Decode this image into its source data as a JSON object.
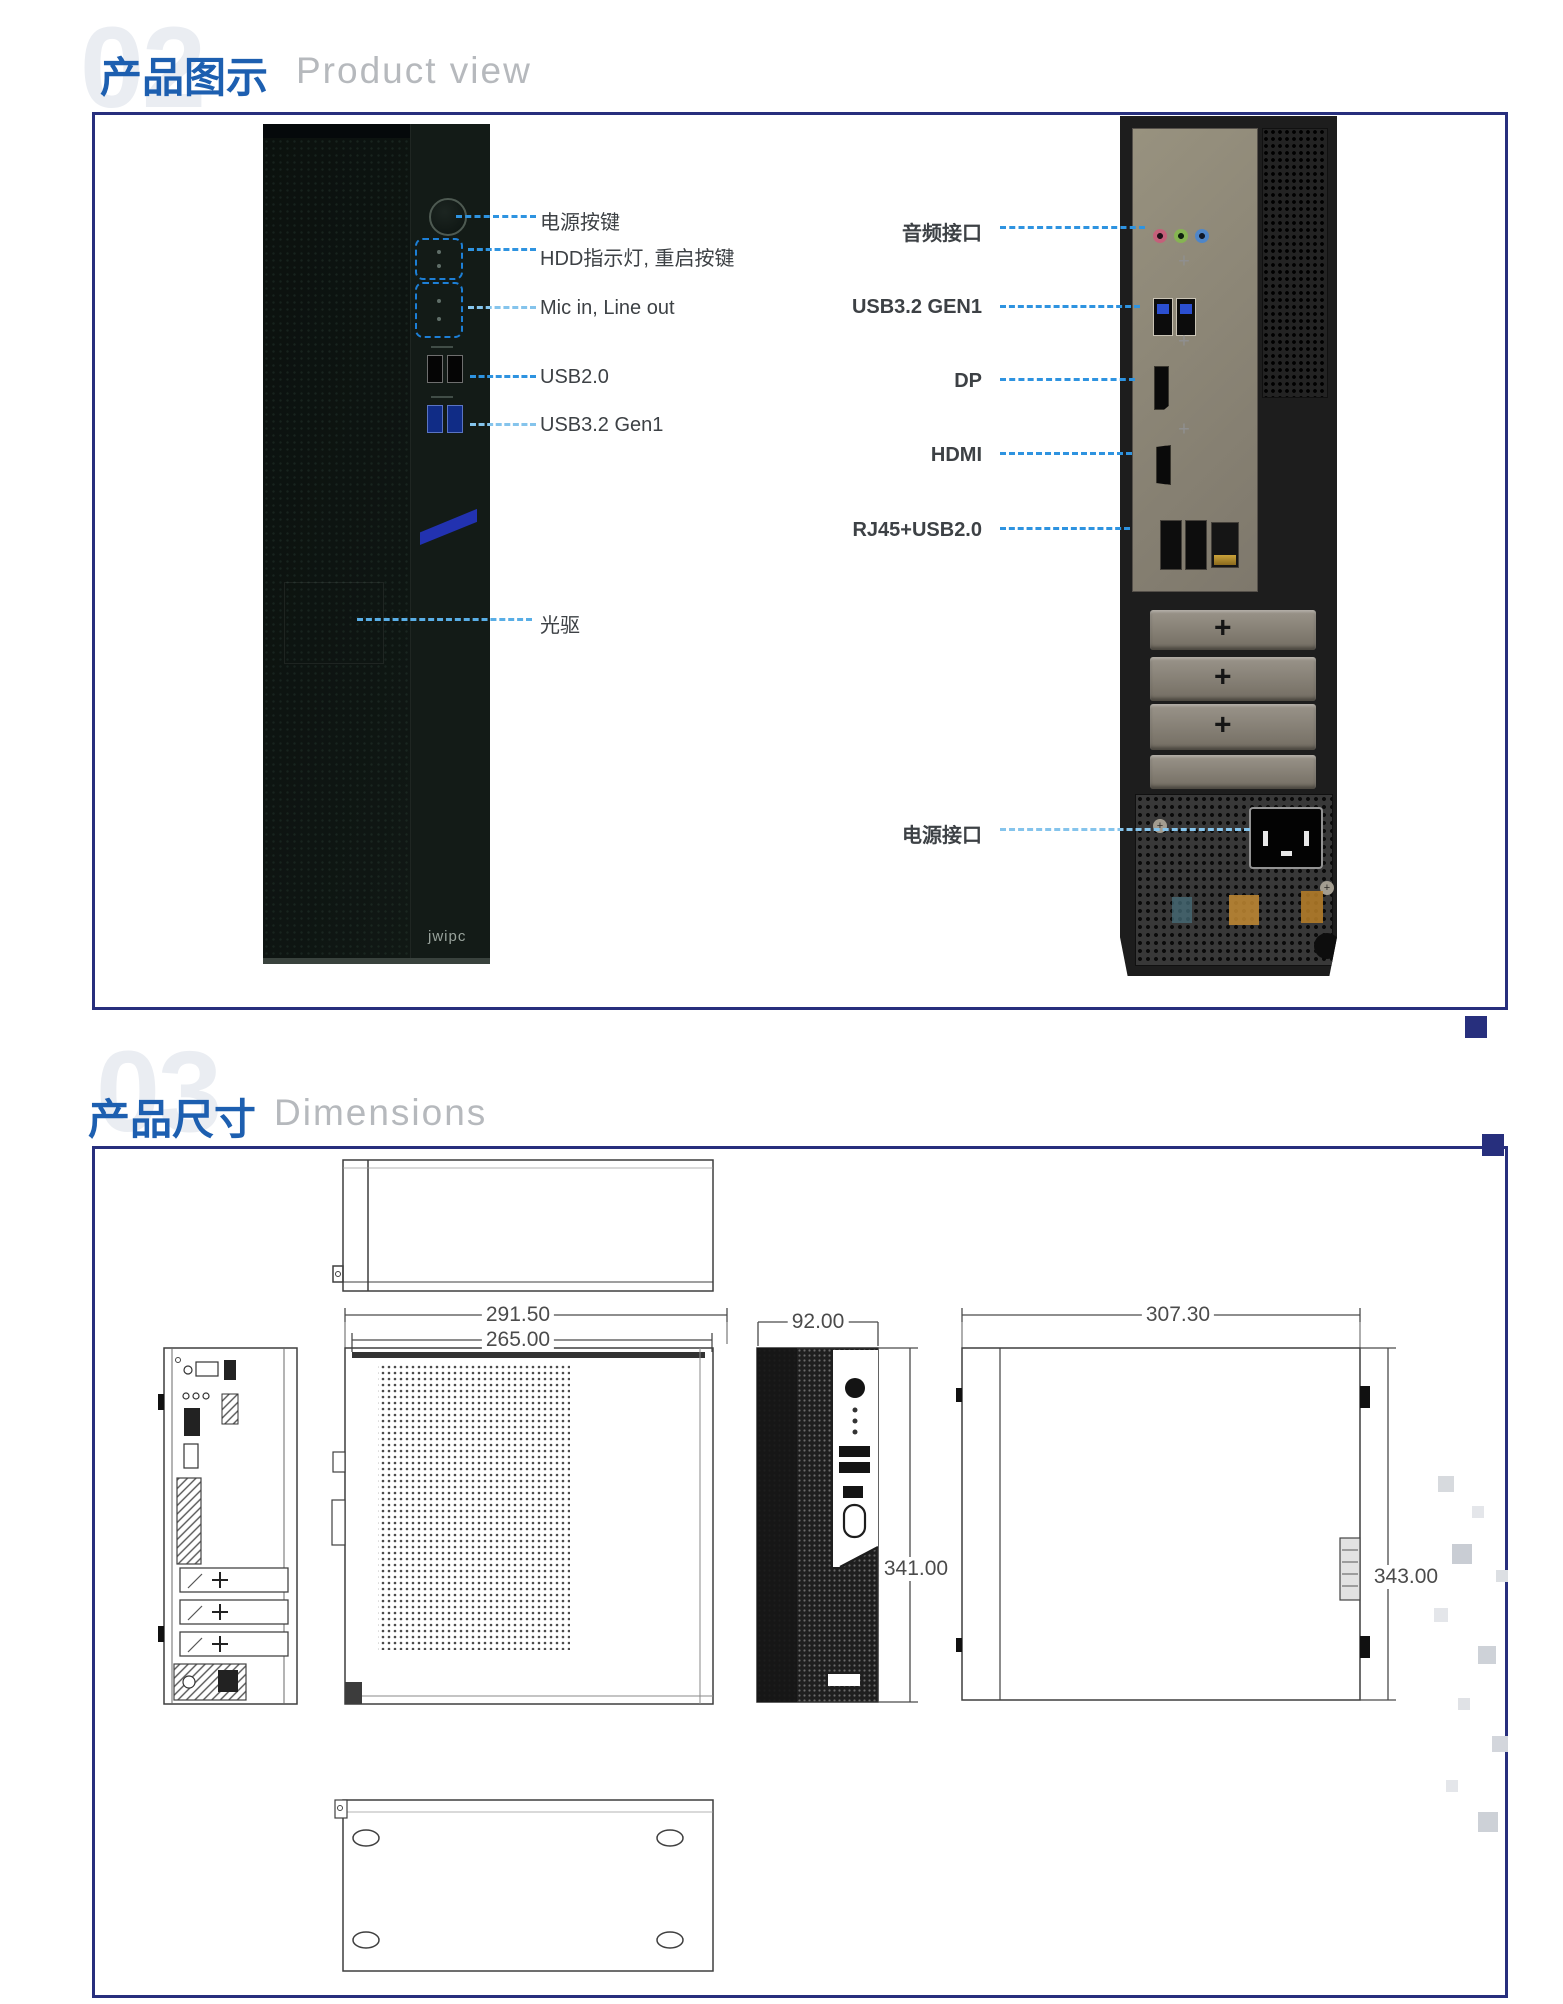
{
  "section2": {
    "number": "02",
    "title_cn": "产品图示",
    "title_en": "Product view",
    "front_labels": [
      {
        "text": "电源按键"
      },
      {
        "text": "HDD指示灯, 重启按键"
      },
      {
        "text": "Mic in, Line out"
      },
      {
        "text": "USB2.0"
      },
      {
        "text": "USB3.2 Gen1"
      },
      {
        "text": "光驱"
      }
    ],
    "rear_labels": [
      {
        "text": "音频接口"
      },
      {
        "text": "USB3.2 GEN1"
      },
      {
        "text": "DP"
      },
      {
        "text": "HDMI"
      },
      {
        "text": "RJ45+USB2.0"
      },
      {
        "text": "电源接口"
      }
    ],
    "brand_logo": "jwipc"
  },
  "section3": {
    "number": "03",
    "title_cn": "产品尺寸",
    "title_en": "Dimensions",
    "dims": {
      "front_width": "291.50",
      "front_inner_width": "265.00",
      "side_width": "92.00",
      "side_height": "341.00",
      "depth": "307.30",
      "rear_height": "343.00"
    }
  },
  "decor": {
    "screw_cross": "+"
  },
  "colors": {
    "accent_navy": "#272f7d",
    "title_blue": "#1d5fb0",
    "subtitle_gray": "#b6b9bd",
    "leader_blue": "#2e93e0",
    "leader_light_blue": "#85c4ec",
    "chassis_dark": "#0e1512",
    "stripe_blue": "#2232b0"
  }
}
